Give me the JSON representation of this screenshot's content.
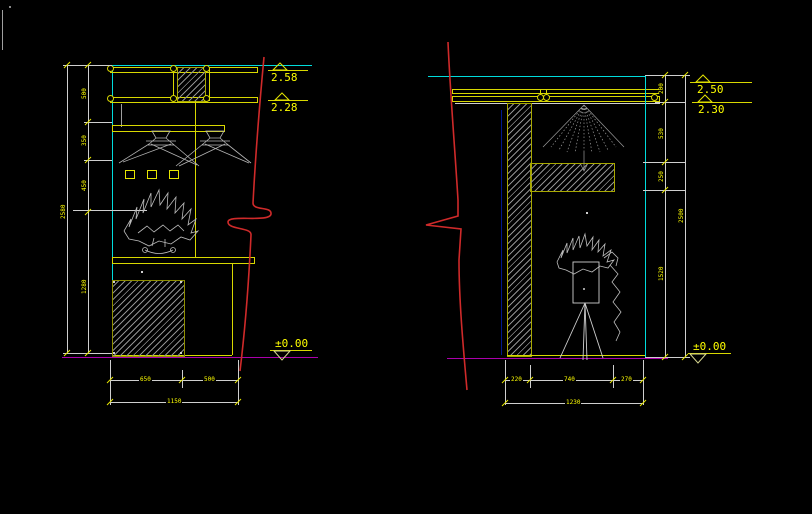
{
  "canvas": {
    "description": "CAD interior elevation drawings on black model space"
  },
  "palette": {
    "line_white": "#cfcfcf",
    "line_yellow": "#d8d800",
    "text_yellow": "#ffff00",
    "cyan": "#00dcdc",
    "magenta": "#aa00aa",
    "red": "#cf2a2a",
    "hatch_gray": "#8f8f8f",
    "dark_blue": "#001a8c"
  },
  "left_view": {
    "levels": [
      {
        "value": "2.58"
      },
      {
        "value": "2.28"
      }
    ],
    "datum": {
      "value": "±0.00"
    },
    "vertical_dims": {
      "segments": [
        "500",
        "350",
        "450",
        "1280"
      ],
      "overall": "2580"
    },
    "bottom_dims": {
      "segments": [
        "650",
        "500"
      ],
      "overall": "1150"
    }
  },
  "right_view": {
    "levels": [
      {
        "value": "2.50"
      },
      {
        "value": "2.30"
      }
    ],
    "datum": {
      "value": "±0.00"
    },
    "vertical_dims": {
      "segments": [
        "200",
        "530",
        "250",
        "1520"
      ],
      "overall": "2500"
    },
    "bottom_dims": {
      "segments": [
        "220",
        "740",
        "270"
      ],
      "overall": "1230"
    }
  }
}
